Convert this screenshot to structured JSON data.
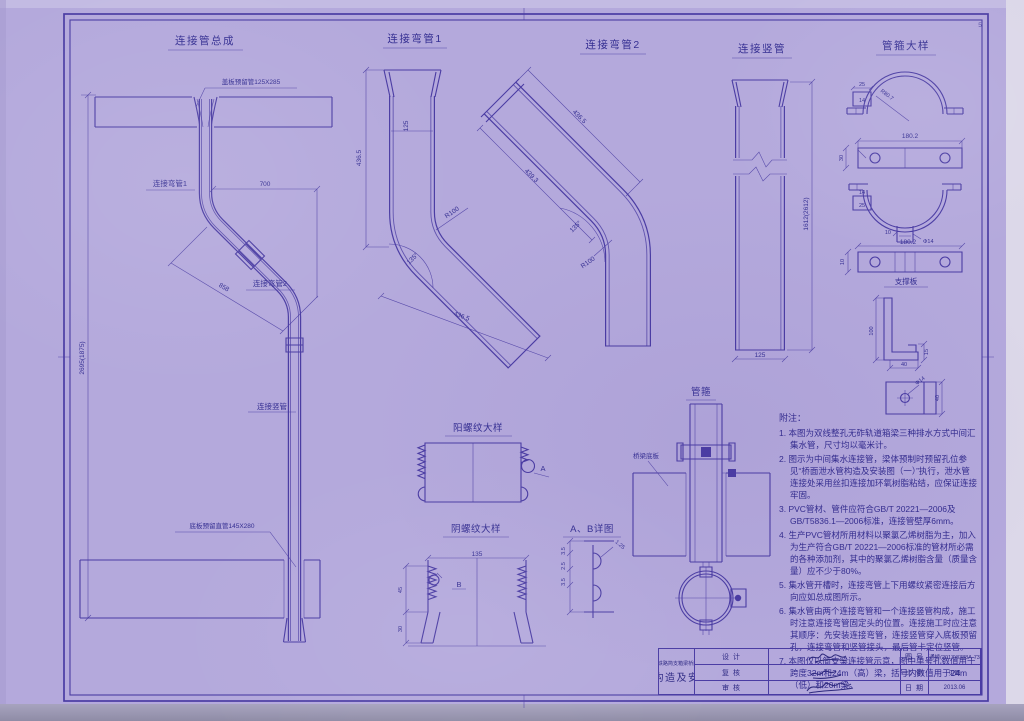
{
  "page": {
    "corner_mark": "5",
    "paper_color": "#b4a9dc",
    "ink_color": "#4a3ca3"
  },
  "figures": {
    "assembly": {
      "title": "连接管总成",
      "top_label": "盖板预留管125X285",
      "bottom_label": "底板预留直管145X280",
      "bend1_label": "连接弯管1",
      "bend2_label": "连接弯管2",
      "riser_label": "连接竖管",
      "dim_width": "700",
      "dim_diag": "858",
      "dim_height": "2695(1875)"
    },
    "bend1": {
      "title": "连接弯管1",
      "dim_bore": "125",
      "dim_leg1": "436.5",
      "dim_radius": "R100",
      "dim_angle": "135°",
      "dim_leg2": "436.5"
    },
    "bend2": {
      "title": "连接弯管2",
      "dim_leg1": "436.5",
      "dim_leg2": "439.3",
      "dim_radius": "R100",
      "dim_angle": "135°"
    },
    "riser": {
      "title": "连接竖管",
      "dim_bore": "125",
      "dim_height": "1612(2612)"
    },
    "clamp_detail": {
      "title": "管箍大样",
      "dim_width_top": "180.2",
      "dim_width_bottom": "180.2",
      "dim_25": "25",
      "dim_14": "14",
      "dim_14b": "14",
      "dim_25b": "25",
      "dim_radius": "R80.7",
      "dim_30": "30",
      "dim_10": "10",
      "dim_notch_10": "10",
      "dim_hole": "Φ14",
      "plate_title": "支撑板",
      "bracket_height": "100",
      "bracket_width": "40",
      "bracket_lip": "15",
      "plate_hole": "Φ14",
      "plate_width": "40"
    },
    "male_thread": {
      "title": "阳螺纹大样",
      "marker": "A"
    },
    "female_thread": {
      "title": "阴螺纹大样",
      "dim_width": "135",
      "dim_45": "45",
      "dim_30": "30",
      "marker": "B"
    },
    "ab_detail": {
      "title": "A、B详图",
      "dim_a": "3.5",
      "dim_b": "2.5",
      "dim_c": "3.5",
      "dim_leader": "1.25"
    },
    "pipe_clamp": {
      "title": "管箍",
      "slab_label": "桥梁底板"
    }
  },
  "notes": {
    "heading": "附注：",
    "items": [
      "1. 本图为双线整孔无砟轨道箱梁三种排水方式中间汇集水管，尺寸均以毫米计。",
      "2. 图示为中间集水连接管，梁体预制时预留孔位参见“桥面泄水管构造及安装图（一）”执行，泄水管连接处采用丝扣连接加环氧树脂粘结，应保证连接牢固。",
      "3. PVC管材、管件应符合GB/T 20221—2006及GB/T5836.1—2006标准，连接管壁厚6mm。",
      "4. 生产PVC管材所用材料以聚氯乙烯树脂为主，加入为生产符合GB/T 20221—2006标准的管材所必需的各种添加剂，其中的聚氯乙烯树脂含量（质量含量）应不少于80%。",
      "5. 集水管开槽时，连接弯管上下用螺纹紧密连接后方向应如总成图所示。",
      "6. 集水管由两个连接弯管和一个连接竖管构成，施工时注意连接弯管固定头的位置。连接施工时应注意其顺序：先安装连接弯管，连接竖管穿入底板预留孔，连接弯管和竖管接头，最后管卡定位竖管。",
      "7. 本图仅以简支梁连接管示意，图中单号孔数值用于跨度32m和24m（高）梁，括号内数值用于24m（低）和20m梁。"
    ]
  },
  "titleblock": {
    "roles": {
      "design": "设 计",
      "check": "复 核",
      "review": "审 核"
    },
    "project": "时速350公里高速铁路简支箱梁桥面附属设施通用图",
    "title": "桥面泄水管构造及安装图（二）",
    "fields": {
      "no_label": "图 号",
      "no_value": "通桥(2013)8388A-73",
      "scale_label": "比 例",
      "scale_value": "见图",
      "date_label": "日 期",
      "date_value": "2013.06"
    }
  }
}
